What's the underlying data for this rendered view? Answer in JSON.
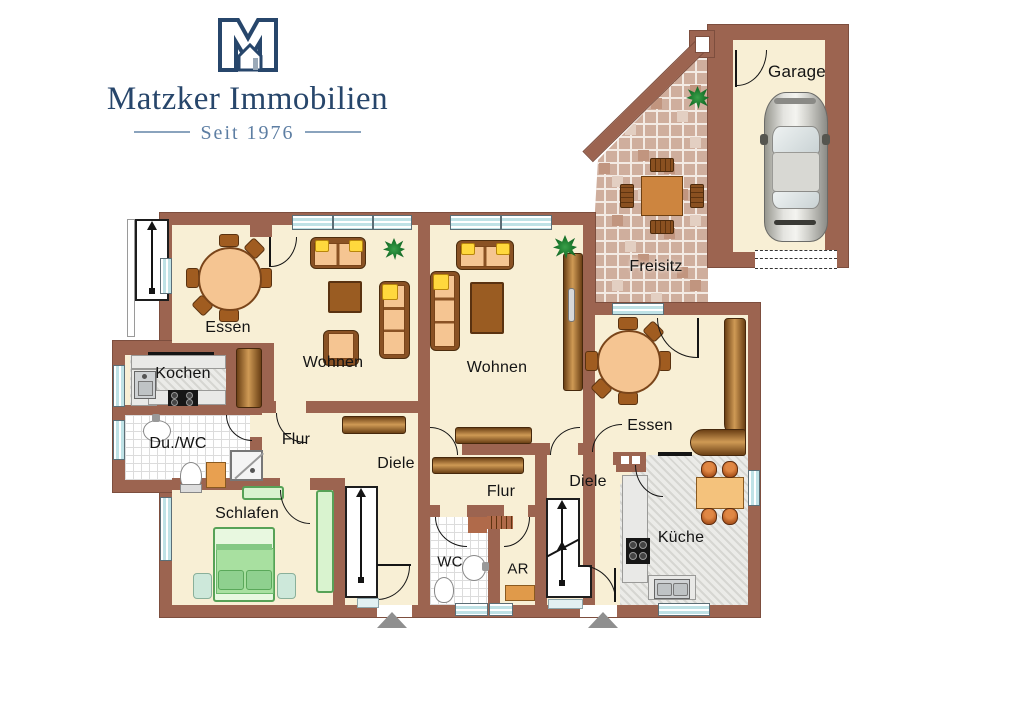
{
  "logo": {
    "monogram_alt": "M house monogram",
    "title": "Matzker Immobilien",
    "tagline": "Seit 1976"
  },
  "floorplan": {
    "labels": {
      "garage": "Garage",
      "freisitz": "Freisitz",
      "essen_left": "Essen",
      "wohnen_left": "Wohnen",
      "kochen": "Kochen",
      "du_wc": "Du./WC",
      "flur_left": "Flur",
      "diele_left": "Diele",
      "schlafen": "Schlafen",
      "wohnen_right": "Wohnen",
      "essen_right": "Essen",
      "flur_right": "Flur",
      "diele_right": "Diele",
      "wc": "WC",
      "ar": "AR",
      "kueche": "Küche"
    },
    "colors": {
      "wall": "#9c6450",
      "floor": "#f8efd5",
      "tile_base": "#cfae9d",
      "window": "#bfe2e6",
      "brand": "#27466b",
      "furniture_green": "#d9f3cf",
      "furniture_wood": "#cf9a55"
    }
  }
}
